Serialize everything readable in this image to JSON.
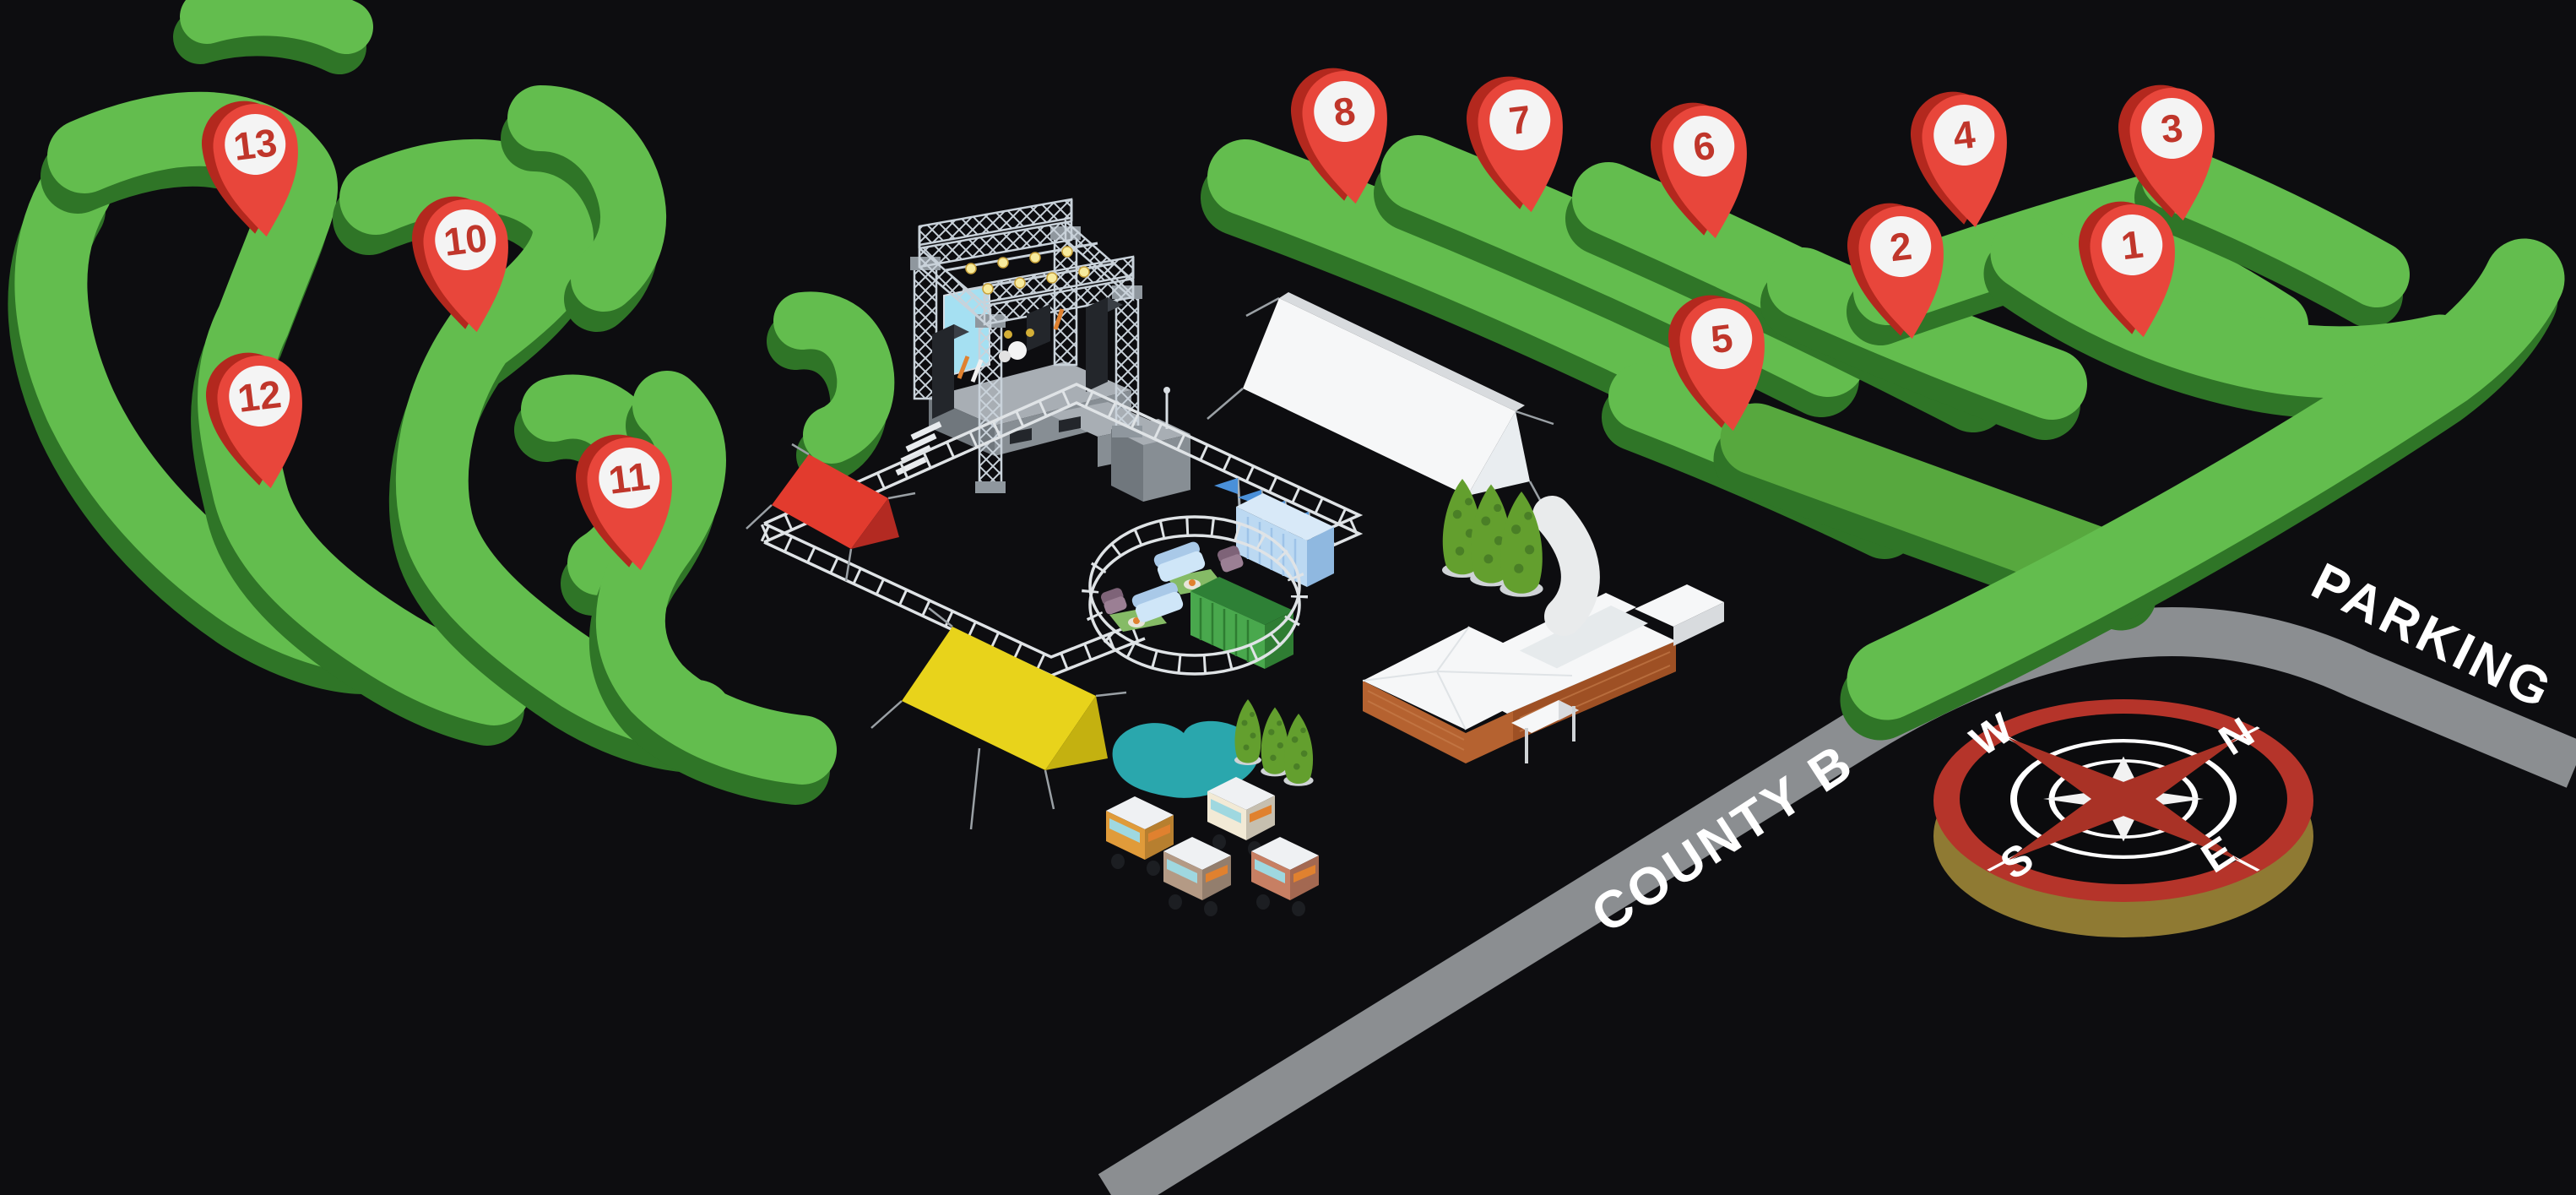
{
  "labels": {
    "road": "COUNTY B",
    "parking": "PARKING"
  },
  "compass": {
    "north": "N",
    "east": "E",
    "south": "S",
    "west": "W"
  },
  "pins": [
    {
      "label": "1"
    },
    {
      "label": "2"
    },
    {
      "label": "3"
    },
    {
      "label": "4"
    },
    {
      "label": "5"
    },
    {
      "label": "6"
    },
    {
      "label": "7"
    },
    {
      "label": "8"
    },
    {
      "label": "10"
    },
    {
      "label": "11"
    },
    {
      "label": "12"
    },
    {
      "label": "13"
    }
  ],
  "colors": {
    "bg": "#0d0d10",
    "green-top": "#63bd4e",
    "green-side": "#2f7527",
    "green-dark": "#57a83e",
    "pin-red": "#e8463b",
    "pin-red-dark": "#b3281e",
    "pin-circle": "#f4f4f4",
    "pin-number": "#c0362b",
    "road-gray": "#8b8e91",
    "pond-teal": "#2aa7ad",
    "tent-yellow": "#e8d31b",
    "tent-yellow-dark": "#c4b110",
    "tent-red": "#e23b2e",
    "tent-red-dark": "#b32a22",
    "white-soft": "#f6f7f8",
    "light-gray": "#d8dbde",
    "truss": "#c9d2da",
    "deck-top": "#a8aeb4",
    "deck-front": "#878e94",
    "deck-left": "#70777d",
    "screen-blue": "#a5e0f2",
    "container-blue": "#bcd9f2",
    "container-blue-top": "#d8e9f8",
    "container-blue-side": "#8fb8e0",
    "container-green-front": "#49a84d",
    "container-green-top": "#2e8036",
    "container-green-dark": "#2f7d33",
    "flag-blue": "#4a90d9",
    "brick": "#b56230",
    "brick-dark": "#9e5024",
    "brick-lines": "#c9804e",
    "tree-green": "#639f2e",
    "tree-dark": "#4a7f26",
    "tree-base": "#cfd3d6",
    "speaker-dark": "#23262b",
    "speaker-top": "#3a3f46",
    "compass-red": "#b5342a",
    "compass-gold": "#8f7a33",
    "star-red": "#a93226",
    "truck-orange": "#e09b3a",
    "truck-cream": "#f2ead6",
    "truck-taupe": "#b49a85",
    "truck-terra": "#c77f63",
    "fence-white": "#dfe3e6",
    "guy-gray": "#9aa0a5",
    "glass": "#9fd8e0",
    "donut-orange": "#e0812f",
    "mat-green": "#85bb66",
    "couch-blue": "#cfe6f8",
    "couch-blue-dark": "#a9c9e8",
    "chair-mauve": "#9b7f94",
    "chair-mauve-dark": "#7e6378",
    "step-gray": "#e8ebee",
    "light-yellow": "#f7eb9e",
    "light-stroke": "#c9a23a",
    "path-white": "#e9ebec"
  }
}
